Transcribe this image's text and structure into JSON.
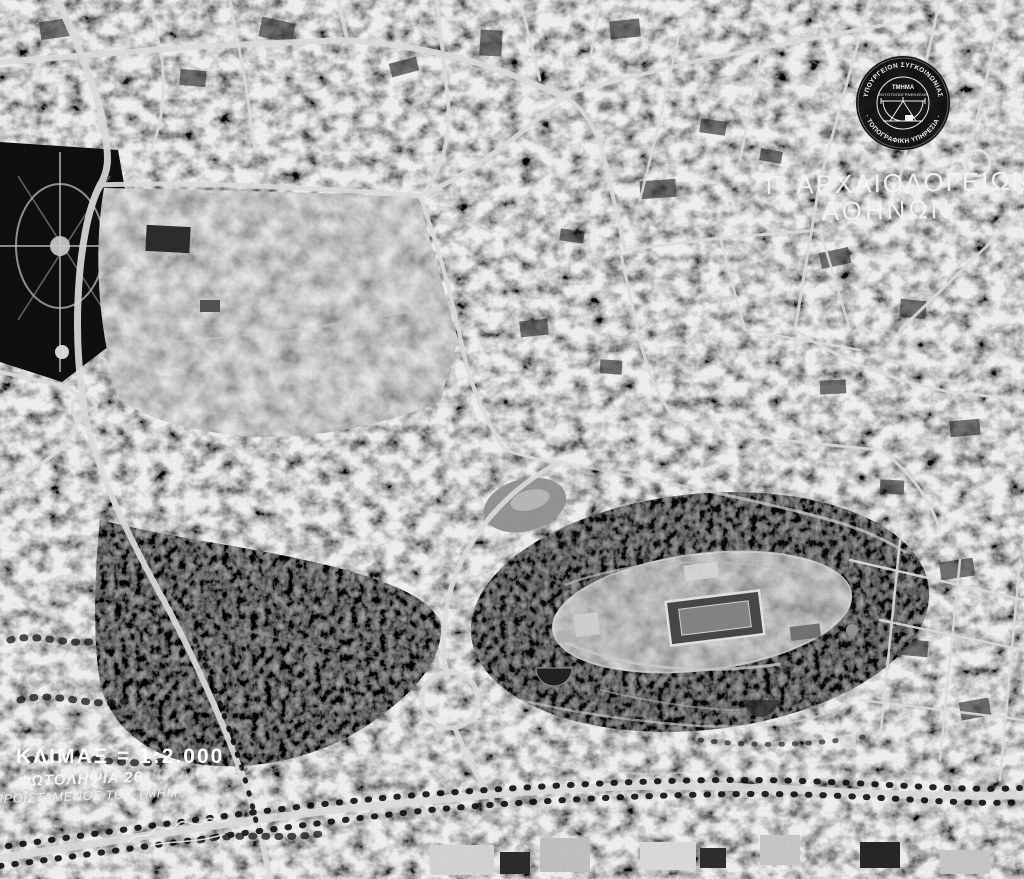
{
  "stamp": {
    "ring_top": "ΥΠΟΥΡΓΕΙΟΝ ΣΥΓΚΟΙΝΩΝΙΑΣ",
    "ring_bottom": "· ΤΟΠΟΓΡΑΦΙΚΗ ΥΠΗΡΕΣΙΑ ·",
    "inner_line1": "ΤΜΗΜΑ",
    "inner_line2": "ΦΩΤΟΤΟΠΟΓΡΑΦΗΣΕΩΝ",
    "icon": "survey-instrument-icon",
    "bg_color": "#070707",
    "text_color": "#f2f2f2"
  },
  "caption": {
    "line1": "Γ. ΑΡΧΑΙΟΛΟΓΕΙΩΝ",
    "line2": "ΑΘΗΝΩΝ"
  },
  "annotations": {
    "scale": "ΚΛΙΜΑΞ = 1:2.000",
    "date_visible": "ΦΩΤΟΛΗΨΙΑ 26",
    "date_faded": "ΙΟΥΛΙΟΥ 1927",
    "credit_visible": "ΠΡΟΪΣΤΑΜΕΝΟΣ ΤΟΥ ΤΜΗΜ",
    "credit_faded": "ΑΤΟΣ",
    "name_fragment": "ΛΙΑΤΟΣ"
  },
  "colors": {
    "overlay_text": "#f4f4f4",
    "photo_dark": "#121212",
    "photo_light": "#c6c6c6"
  }
}
